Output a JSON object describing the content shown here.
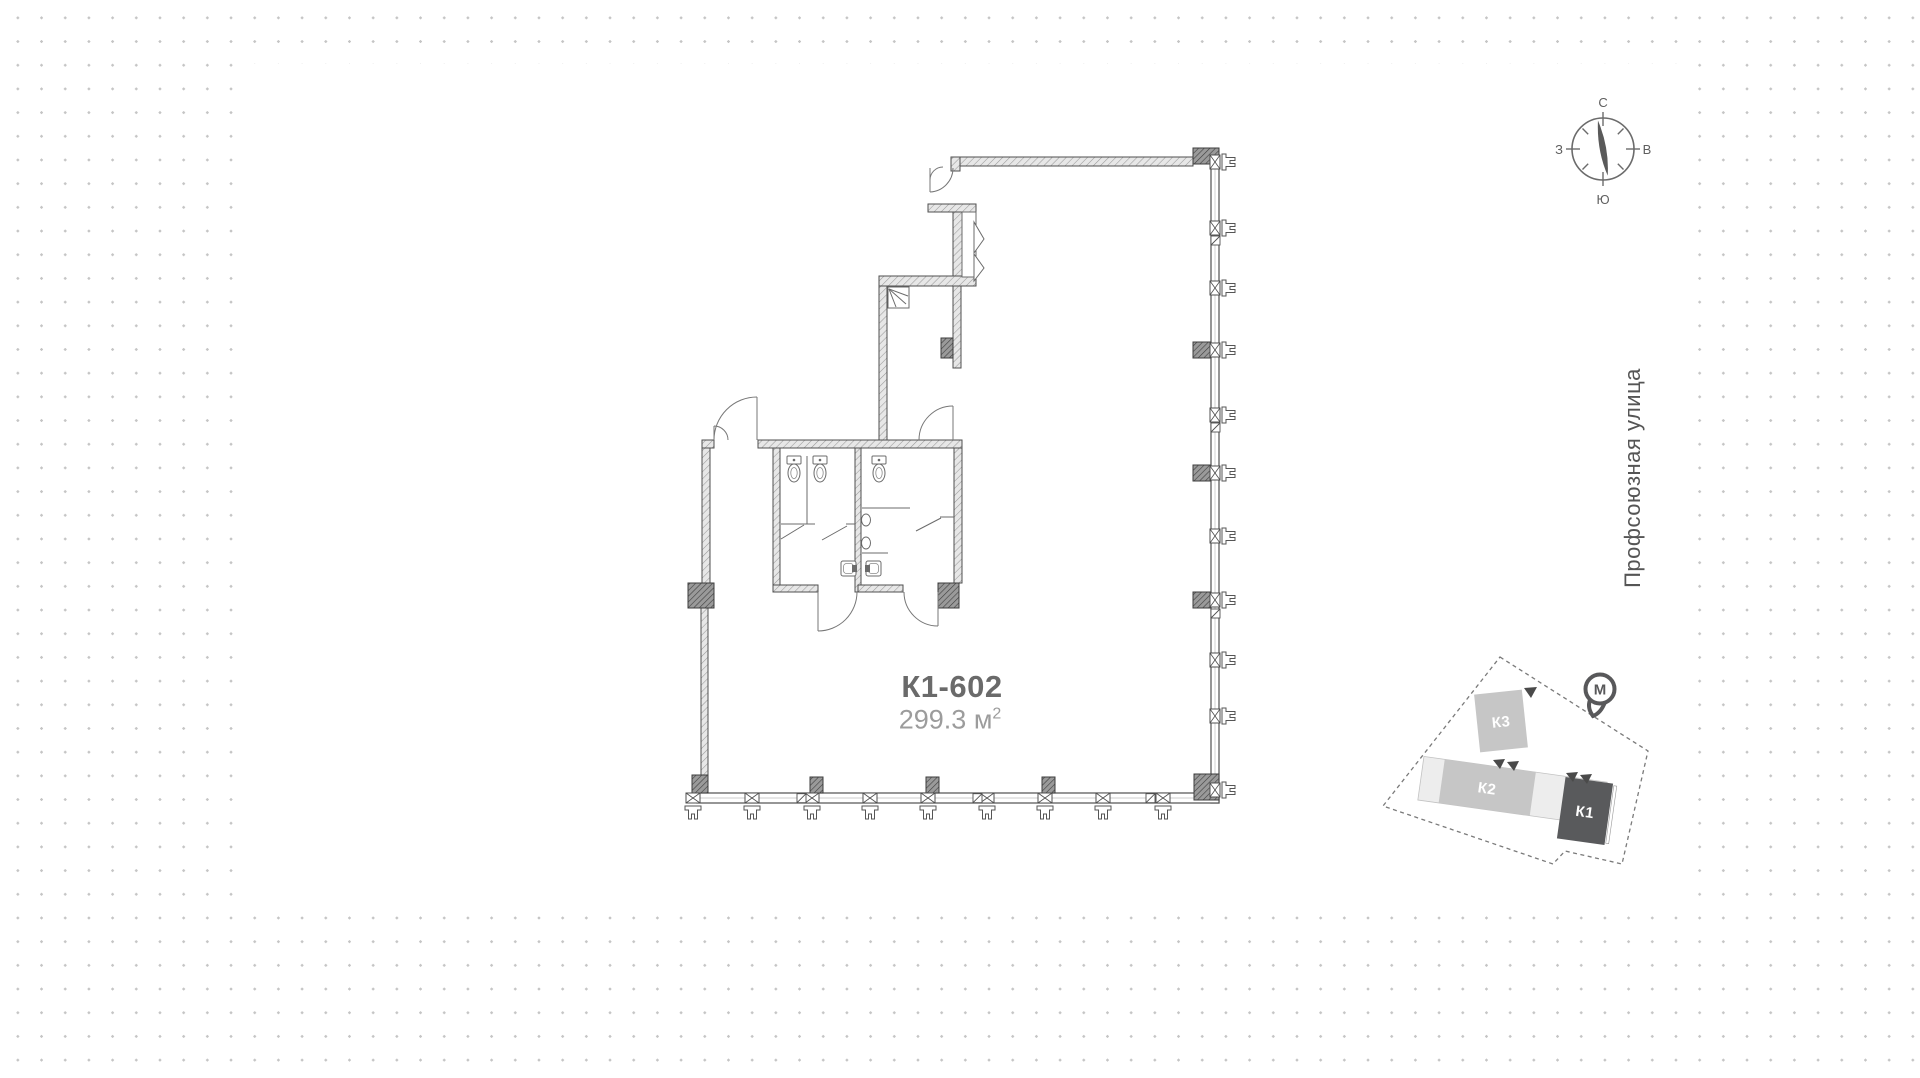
{
  "unit": {
    "code": "К1-602",
    "area_value": "299.3",
    "area_unit": "м",
    "area_exponent": "2"
  },
  "street": {
    "name": "Профсоюзная улица"
  },
  "compass": {
    "north": "С",
    "east": "В",
    "south": "Ю",
    "west": "З"
  },
  "minimap": {
    "buildings": [
      {
        "id": "k3",
        "label": "К3",
        "color": "#c6c6c6"
      },
      {
        "id": "k2",
        "label": "К2",
        "color": "#c6c6c6"
      },
      {
        "id": "k1",
        "label": "К1",
        "color": "#595a5c"
      }
    ],
    "metro_label": "М"
  },
  "colors": {
    "background_dot": "#c5c5c5",
    "panel": "#ffffff",
    "wall_line": "#4f4f4f",
    "pier_fill": "#8c8c8c",
    "building_light": "#c6c6c6",
    "building_dark": "#595a5c",
    "unit_code_text": "#6a6a6a",
    "unit_area_text": "#9c9c9c"
  }
}
